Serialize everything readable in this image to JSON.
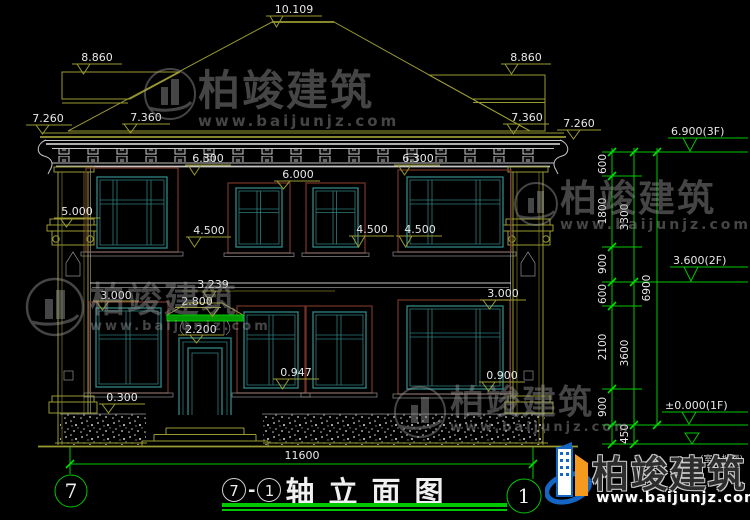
{
  "watermark": {
    "name": "柏竣建筑",
    "url": "www.baijunjz.com"
  },
  "title": {
    "axis_left": "7",
    "sep": "-",
    "axis_right": "1",
    "text": "轴立面图"
  },
  "axes": {
    "left": "7",
    "right": "1"
  },
  "bottom_dim": "11600",
  "elev_markers": {
    "ridge": "10.109",
    "wing_left": "8.860",
    "wing_right": "8.860",
    "eave_tip_left": "7.260",
    "eave_tip_right": "7.260",
    "fascia_left": "7.360",
    "fascia_right": "7.360",
    "f2_head_left": "6.300",
    "f2_head_right": "6.300",
    "f2_head_mid": "6.000",
    "pilaster_cap": "5.000",
    "f2_sill_left": "4.500",
    "f2_sill_mid": "4.500",
    "f2_sill_right": "4.500",
    "f1_head_left": "3.000",
    "f1_head_right": "3.000",
    "canopy_ridge": "3.239",
    "canopy_eave": "2.800",
    "door_head": "2.200",
    "f1_sill_mid": "0.947",
    "f1_sill_right": "0.900",
    "plinth_top": "0.300"
  },
  "levels": {
    "floor3": "6.900(3F)",
    "floor2": "3.600(2F)",
    "floor1": "±0.000(1F)",
    "ground_note": "(室外地面)"
  },
  "chain": {
    "col1": [
      "600",
      "1800",
      "900",
      "600",
      "2100",
      "900"
    ],
    "col2": [
      "3300",
      "3600",
      "450"
    ],
    "total": "6900"
  },
  "colors": {
    "background": "#000000",
    "dim_green": "#00c800",
    "line_olive": "#9a9a33",
    "window_teal": "#2e7d7d",
    "casing_maroon": "#6e3226",
    "text_white": "#e8e8e8",
    "logo_blue": "#1565c5",
    "logo_orange": "#f59a1d"
  }
}
